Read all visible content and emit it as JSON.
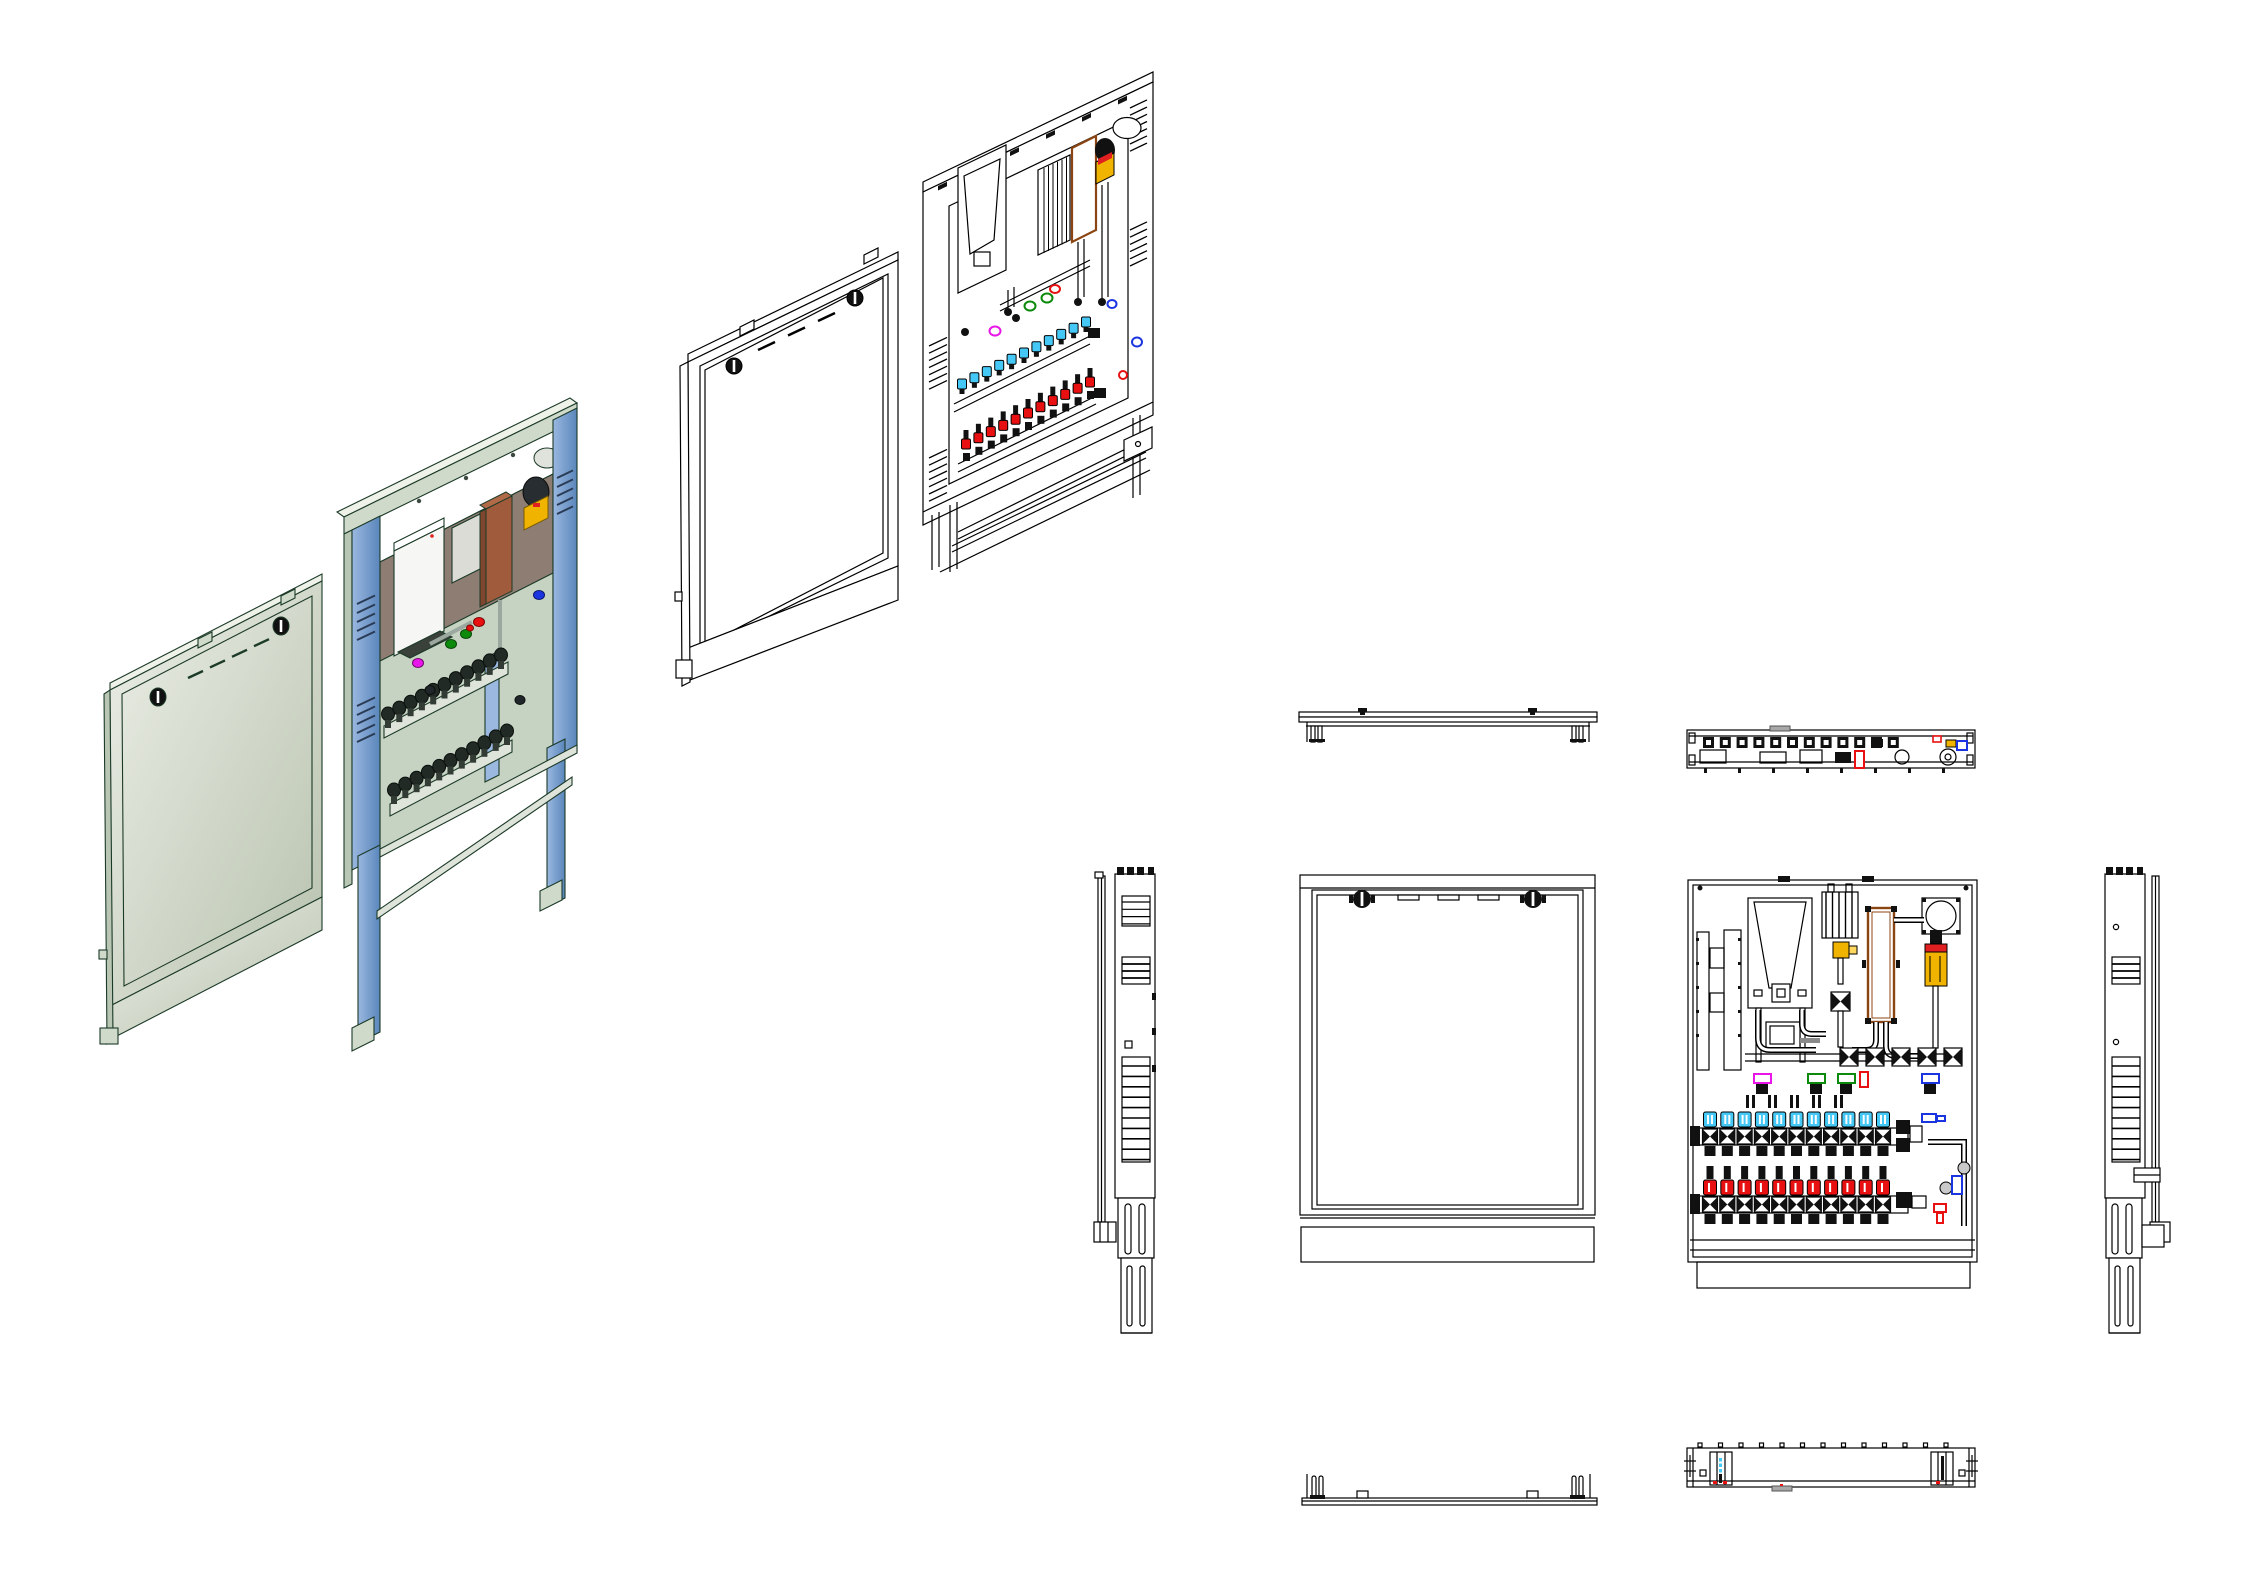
{
  "page": {
    "width": 2268,
    "height": 1583,
    "background": "#ffffff"
  },
  "colors": {
    "line": "#000000",
    "iso_line": "#1c3a28",
    "sage": "#cfdacb",
    "sage_dark": "#b9c6b4",
    "sage_light": "#eef2e8",
    "interior": "#c6d2c2",
    "back_brown": "#8d7d73",
    "blue_light": "#9ab8e0",
    "blue_dark": "#5a86bb",
    "boiler_white": "#f6f7f4",
    "gray_box": "#dcdcd6",
    "copper": "#a05a3c",
    "copper_dark": "#7e462e",
    "hx_outline": "#8b4513",
    "vessel_gray": "#dfe3dc",
    "pump_dark": "#272d30",
    "pump_yellow": "#f0b400",
    "pump_red": "#e02020",
    "valve_cyan": "#45c8f5",
    "valve_red": "#e81010",
    "valve_green": "#0c8a0c",
    "valve_blue": "#1a35e0",
    "valve_magenta": "#e816e8",
    "dark": "#111111",
    "metal": "#c9c9c9",
    "tab_gray": "#a8a8a8",
    "bar": "#dfe4da",
    "pipe_gray": "#9aa8a0"
  },
  "manifold": {
    "loops": 11
  },
  "views": {
    "iso_door_rendered": {
      "vent_dashes": 4,
      "locks": 2
    },
    "iso_cabinet_rendered": {
      "band_screws": 5,
      "stile_louvers": 5
    },
    "iso_door_lineart": {
      "vent_dashes": 3,
      "locks": 2
    },
    "iso_cabinet_lineart": {
      "top_tabs": 6,
      "stile_louvers": 7,
      "stile_louvers_right": 6
    },
    "top_door": {
      "clips": 2
    },
    "top_cabinet": {
      "modules": 12,
      "bottom_ticks": 8
    },
    "front_door": {
      "locks": 2,
      "vent_slots": 3
    },
    "front_cabinet": {
      "valve_crosses": 5,
      "connectors": 5
    },
    "side_left": {
      "louvers_large": 10,
      "louvers_small": 4,
      "louvers_small2": 3
    },
    "side_right": {
      "louvers_large": 10,
      "louvers_small": 3
    },
    "bottom_door": {
      "clips": 2
    },
    "bottom_cabinet": {
      "top_ticks": 13,
      "leg_dashes": 4
    }
  }
}
